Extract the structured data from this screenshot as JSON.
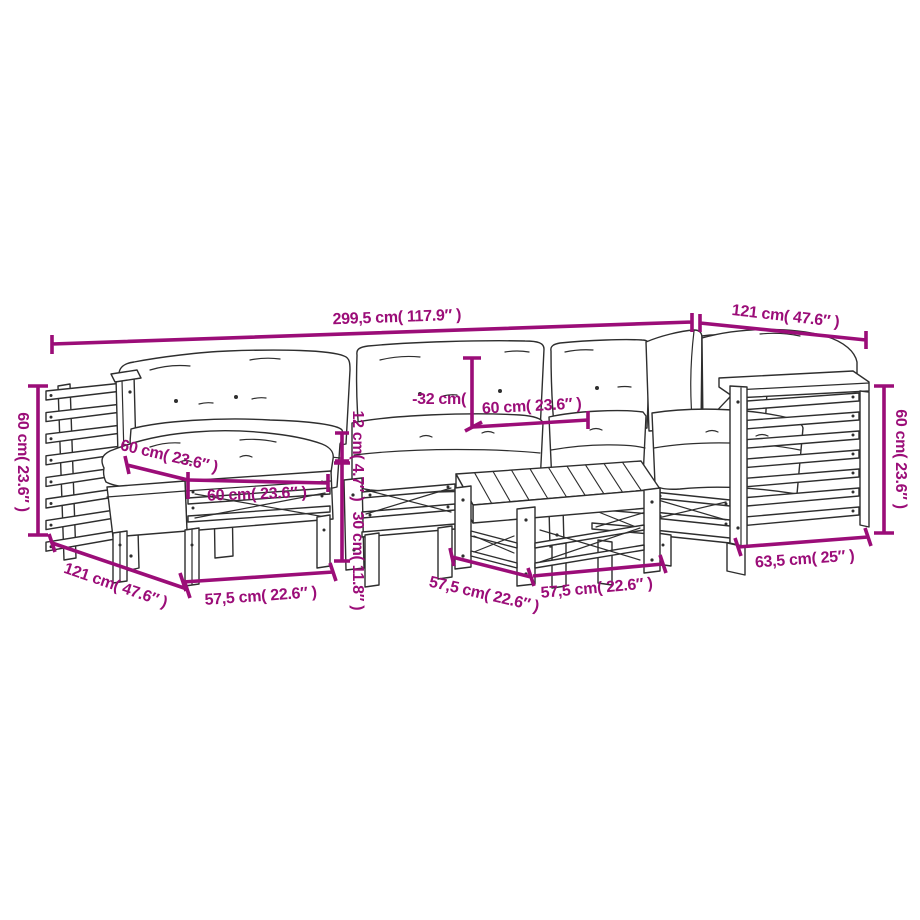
{
  "diagram": {
    "accent_color": "#9b0d78",
    "line_color": "#2e2e2e",
    "background_color": "#ffffff"
  },
  "labels": {
    "total_width": "299,5 cm( 117.9″ )",
    "top_right_depth": "121 cm( 47.6″ )",
    "left_height": "60 cm( 23.6″ )",
    "bottom_left_depth": "121 cm( 47.6″ )",
    "ottoman_cushion_depth": "60 cm( 23.6″ )",
    "ottoman_cushion_width": "60 cm( 23.6″ )",
    "ottoman_frame_width": "57,5 cm( 22.6″ )",
    "seat_cushion_thickness": "12 cm( 4.7″ )",
    "frame_height": "30 cm( 11.8″ )",
    "backrest_cushion_height": "-32 cm(",
    "seat_width": "60 cm( 23.6″ )",
    "table_width_front_left": "57,5 cm( 22.6″ )",
    "table_width_front_right": "57,5 cm( 22.6″ )",
    "corner_module_width": "63,5 cm( 25″ )",
    "right_height": "60 cm( 23.6″ )"
  }
}
